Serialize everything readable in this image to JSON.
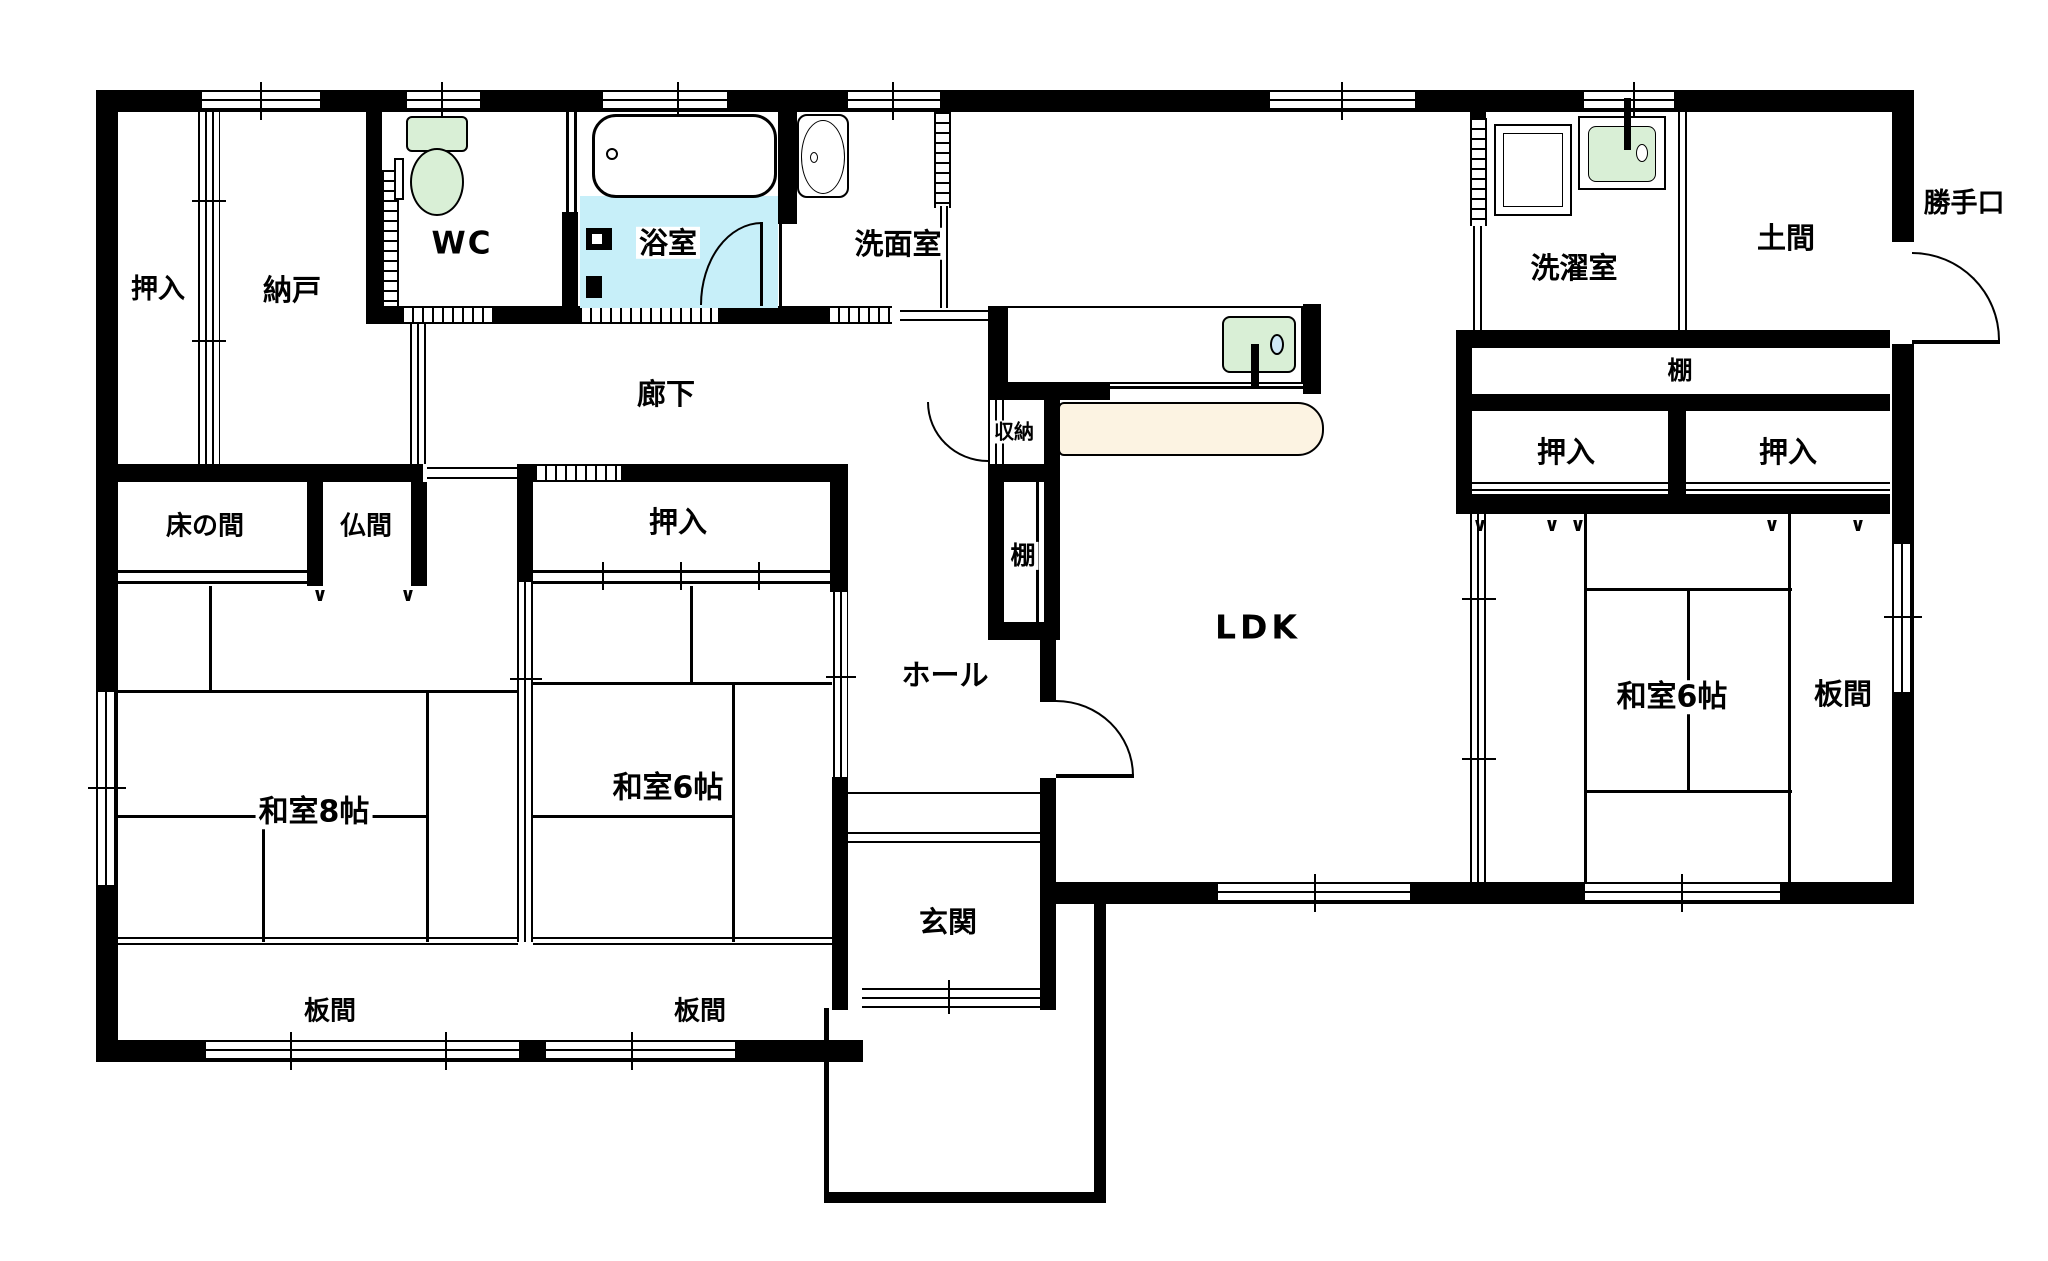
{
  "plan_type": "japanese-house-floor-plan",
  "colors": {
    "wall": "#000000",
    "background": "#ffffff",
    "bath_floor": "#c7eff9",
    "fixture_green": "#d9efd6",
    "counter_cream": "#fcf3e2",
    "drain_blue": "#cfe8f6"
  },
  "icons": [
    "toilet-icon",
    "bathtub-icon",
    "washbasin-icon",
    "washing-machine-icon",
    "laundry-sink-icon",
    "kitchen-sink-icon",
    "kitchen-counter-icon",
    "door-arc-icon"
  ],
  "labels": [
    {
      "id": "oshiire-top-left",
      "text": "押入",
      "x": 158,
      "y": 290,
      "s": 27
    },
    {
      "id": "nando",
      "text": "納戸",
      "x": 292,
      "y": 290,
      "s": 29
    },
    {
      "id": "wc",
      "text": "WC",
      "x": 462,
      "y": 244,
      "s": 31,
      "ls": 2
    },
    {
      "id": "yokushitsu",
      "text": "浴室",
      "x": 668,
      "y": 243,
      "s": 29
    },
    {
      "id": "senmenshitsu",
      "text": "洗面室",
      "x": 898,
      "y": 244,
      "s": 29
    },
    {
      "id": "sentakushitsu",
      "text": "洗濯室",
      "x": 1574,
      "y": 268,
      "s": 29
    },
    {
      "id": "doma",
      "text": "土間",
      "x": 1786,
      "y": 238,
      "s": 29
    },
    {
      "id": "katteguchi",
      "text": "勝手口",
      "x": 1964,
      "y": 204,
      "s": 27
    },
    {
      "id": "tana-right",
      "text": "棚",
      "x": 1680,
      "y": 371,
      "s": 25
    },
    {
      "id": "oshiire-right-1",
      "text": "押入",
      "x": 1566,
      "y": 452,
      "s": 29
    },
    {
      "id": "oshiire-right-2",
      "text": "押入",
      "x": 1788,
      "y": 452,
      "s": 29
    },
    {
      "id": "rouka",
      "text": "廊下",
      "x": 666,
      "y": 394,
      "s": 29
    },
    {
      "id": "shuunou",
      "text": "収納",
      "x": 1014,
      "y": 432,
      "s": 20
    },
    {
      "id": "tana-middle",
      "text": "棚",
      "x": 1023,
      "y": 556,
      "s": 25
    },
    {
      "id": "tokonoma",
      "text": "床の間",
      "x": 205,
      "y": 527,
      "s": 26
    },
    {
      "id": "butsuma",
      "text": "仏間",
      "x": 366,
      "y": 527,
      "s": 26
    },
    {
      "id": "oshiire-left",
      "text": "押入",
      "x": 678,
      "y": 522,
      "s": 29
    },
    {
      "id": "washitsu-8",
      "text": "和室8帖",
      "x": 314,
      "y": 812,
      "s": 30
    },
    {
      "id": "washitsu-6-left",
      "text": "和室6帖",
      "x": 668,
      "y": 788,
      "s": 30
    },
    {
      "id": "washitsu-6-right",
      "text": "和室6帖",
      "x": 1672,
      "y": 697,
      "s": 30
    },
    {
      "id": "itanoma-left",
      "text": "板間",
      "x": 330,
      "y": 1012,
      "s": 26
    },
    {
      "id": "itanoma-center",
      "text": "板間",
      "x": 700,
      "y": 1012,
      "s": 26
    },
    {
      "id": "itanoma-right",
      "text": "板間",
      "x": 1843,
      "y": 694,
      "s": 29
    },
    {
      "id": "hall",
      "text": "ホール",
      "x": 945,
      "y": 675,
      "s": 29
    },
    {
      "id": "genkan",
      "text": "玄関",
      "x": 948,
      "y": 922,
      "s": 29
    },
    {
      "id": "ldk",
      "text": "LDK",
      "x": 1258,
      "y": 628,
      "s": 33,
      "ls": 4
    }
  ]
}
